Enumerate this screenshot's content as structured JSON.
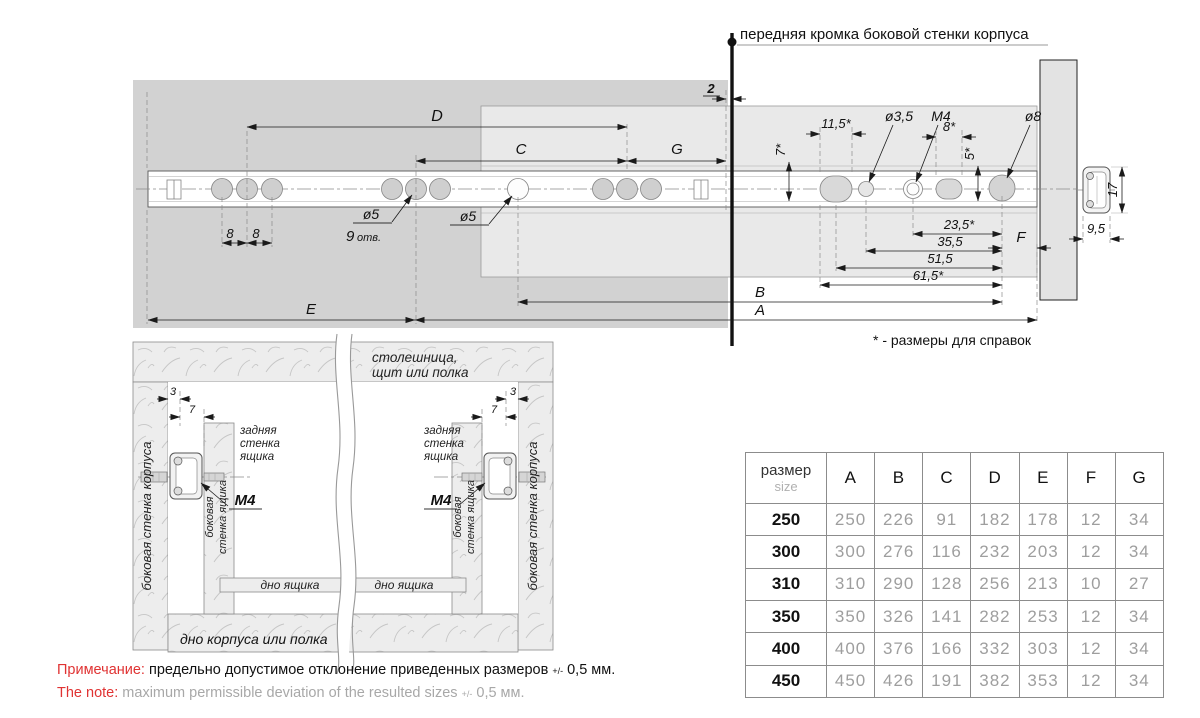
{
  "drawing": {
    "front_edge_label": "передняя кромка боковой стенки корпуса",
    "ref_note": "* - размеры для справок",
    "dims": {
      "d2": "2",
      "D": "D",
      "C": "C",
      "G": "G",
      "s8a": "8",
      "s8b": "8",
      "d5a": "ø5",
      "n9": "9",
      "otv": "отв.",
      "d5b": "ø5",
      "r7": "7*",
      "r115": "11,5*",
      "d35": "ø3,5",
      "m4": "M4",
      "r8": "8*",
      "r5": "5*",
      "d8": "ø8",
      "r235": "23,5*",
      "r355": "35,5",
      "r515": "51,5",
      "r615": "61,5*",
      "F": "F",
      "B": "B",
      "A": "A",
      "E": "E",
      "h17": "17",
      "w95": "9,5"
    }
  },
  "section": {
    "top_panel_1": "столешница,",
    "top_panel_2": "щит или полка",
    "rear_wall_1": "задняя",
    "rear_wall_2": "стенка",
    "rear_wall_3": "ящика",
    "m4": "M4",
    "dim3": "3",
    "dim7": "7",
    "cabinet_wall": "боковая стенка корпуса",
    "drawer_wall_1": "боковая",
    "drawer_wall_2": "стенка ящика",
    "drawer_bottom": "дно ящика",
    "bottom_panel": "дно корпуса или полка"
  },
  "table": {
    "header_col_line1": "размер",
    "header_col_line2": "size",
    "columns": [
      "A",
      "B",
      "C",
      "D",
      "E",
      "F",
      "G"
    ],
    "rows": [
      {
        "size": "250",
        "values": [
          "250",
          "226",
          "91",
          "182",
          "178",
          "12",
          "34"
        ]
      },
      {
        "size": "300",
        "values": [
          "300",
          "276",
          "116",
          "232",
          "203",
          "12",
          "34"
        ]
      },
      {
        "size": "310",
        "values": [
          "310",
          "290",
          "128",
          "256",
          "213",
          "10",
          "27"
        ]
      },
      {
        "size": "350",
        "values": [
          "350",
          "326",
          "141",
          "282",
          "253",
          "12",
          "34"
        ]
      },
      {
        "size": "400",
        "values": [
          "400",
          "376",
          "166",
          "332",
          "303",
          "12",
          "34"
        ]
      },
      {
        "size": "450",
        "values": [
          "450",
          "426",
          "191",
          "382",
          "353",
          "12",
          "34"
        ]
      }
    ]
  },
  "notes": {
    "ru_label": "Примечание:",
    "ru_text": "предельно допустимое отклонение приведенных размеров",
    "ru_pm": "+/-",
    "ru_suffix": "0,5 мм.",
    "en_label": "The note:",
    "en_text": "maximum permissible deviation of the resulted sizes",
    "en_pm": "+/-",
    "en_suffix": "0,5 мм."
  },
  "colors": {
    "accent_red": "#e03333",
    "dark_fill": "#d2d2d2",
    "light_fill": "#e9e9e9"
  }
}
